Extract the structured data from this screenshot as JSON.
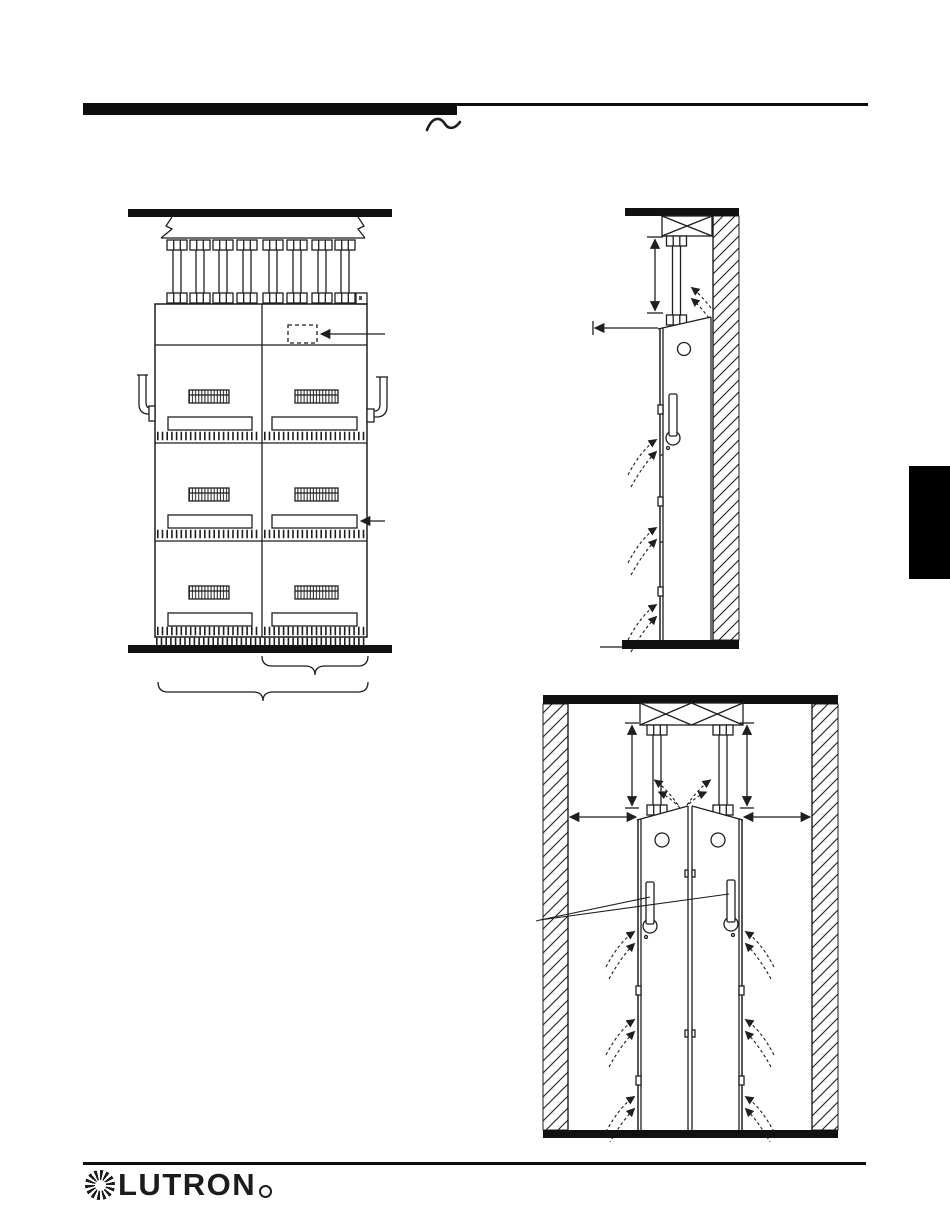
{
  "page": {
    "background": "#ffffff",
    "ink_color": "#1f1f1f",
    "bar_color": "#0d0d0d"
  },
  "header": {
    "squiggle_symbol": "~"
  },
  "side_tab": {
    "color": "#000000"
  },
  "figures": {
    "front_view": {
      "name": "panel-bank-front-view",
      "ceiling_conduits": 8,
      "panel_columns": 2,
      "panel_rows": 3,
      "callout_arrows": 2,
      "braces": 2
    },
    "side_view": {
      "name": "single-panel-wall-side-view",
      "conduits": 1,
      "airflow_arrow_pairs": 3,
      "dimension_lines": 2
    },
    "back_to_back_view": {
      "name": "back-to-back-panels-side-view",
      "conduits": 2,
      "airflow_arrow_pairs": 6,
      "dimension_lines": 4,
      "leader_lines": 2
    }
  },
  "footer": {
    "logo_text": "LUTRON",
    "registered_mark_symbol": "®"
  }
}
